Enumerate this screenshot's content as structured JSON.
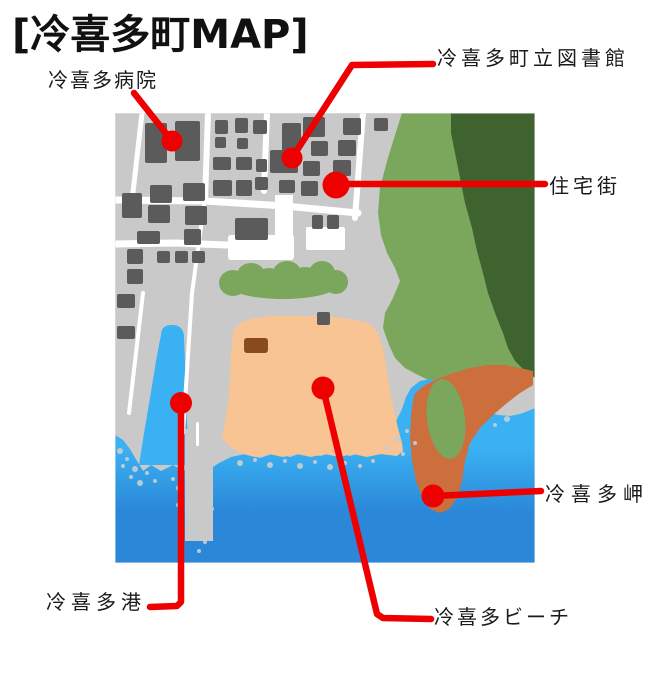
{
  "title": "[冷喜多町MAP]",
  "labels": {
    "hospital": "冷喜多病院",
    "library": "冷喜多町立図書館",
    "residential": "住宅街",
    "cape": "冷喜多岬",
    "port": "冷喜多港",
    "beach": "冷喜多ビーチ"
  },
  "colors": {
    "marker_red": "#EE0000",
    "land_gray": "#C9C9C9",
    "building_gray": "#5B5B5B",
    "road_white": "#FFFFFF",
    "forest_light_green": "#7BA75D",
    "forest_dark_green": "#3E632E",
    "sea_light_blue": "#3AB1F2",
    "sea_deep_blue": "#2B87D8",
    "sand_orange": "#F9C494",
    "cape_brown_orange": "#CC6F3D",
    "hut_brown": "#8A4A1F",
    "title_black": "#111111"
  }
}
